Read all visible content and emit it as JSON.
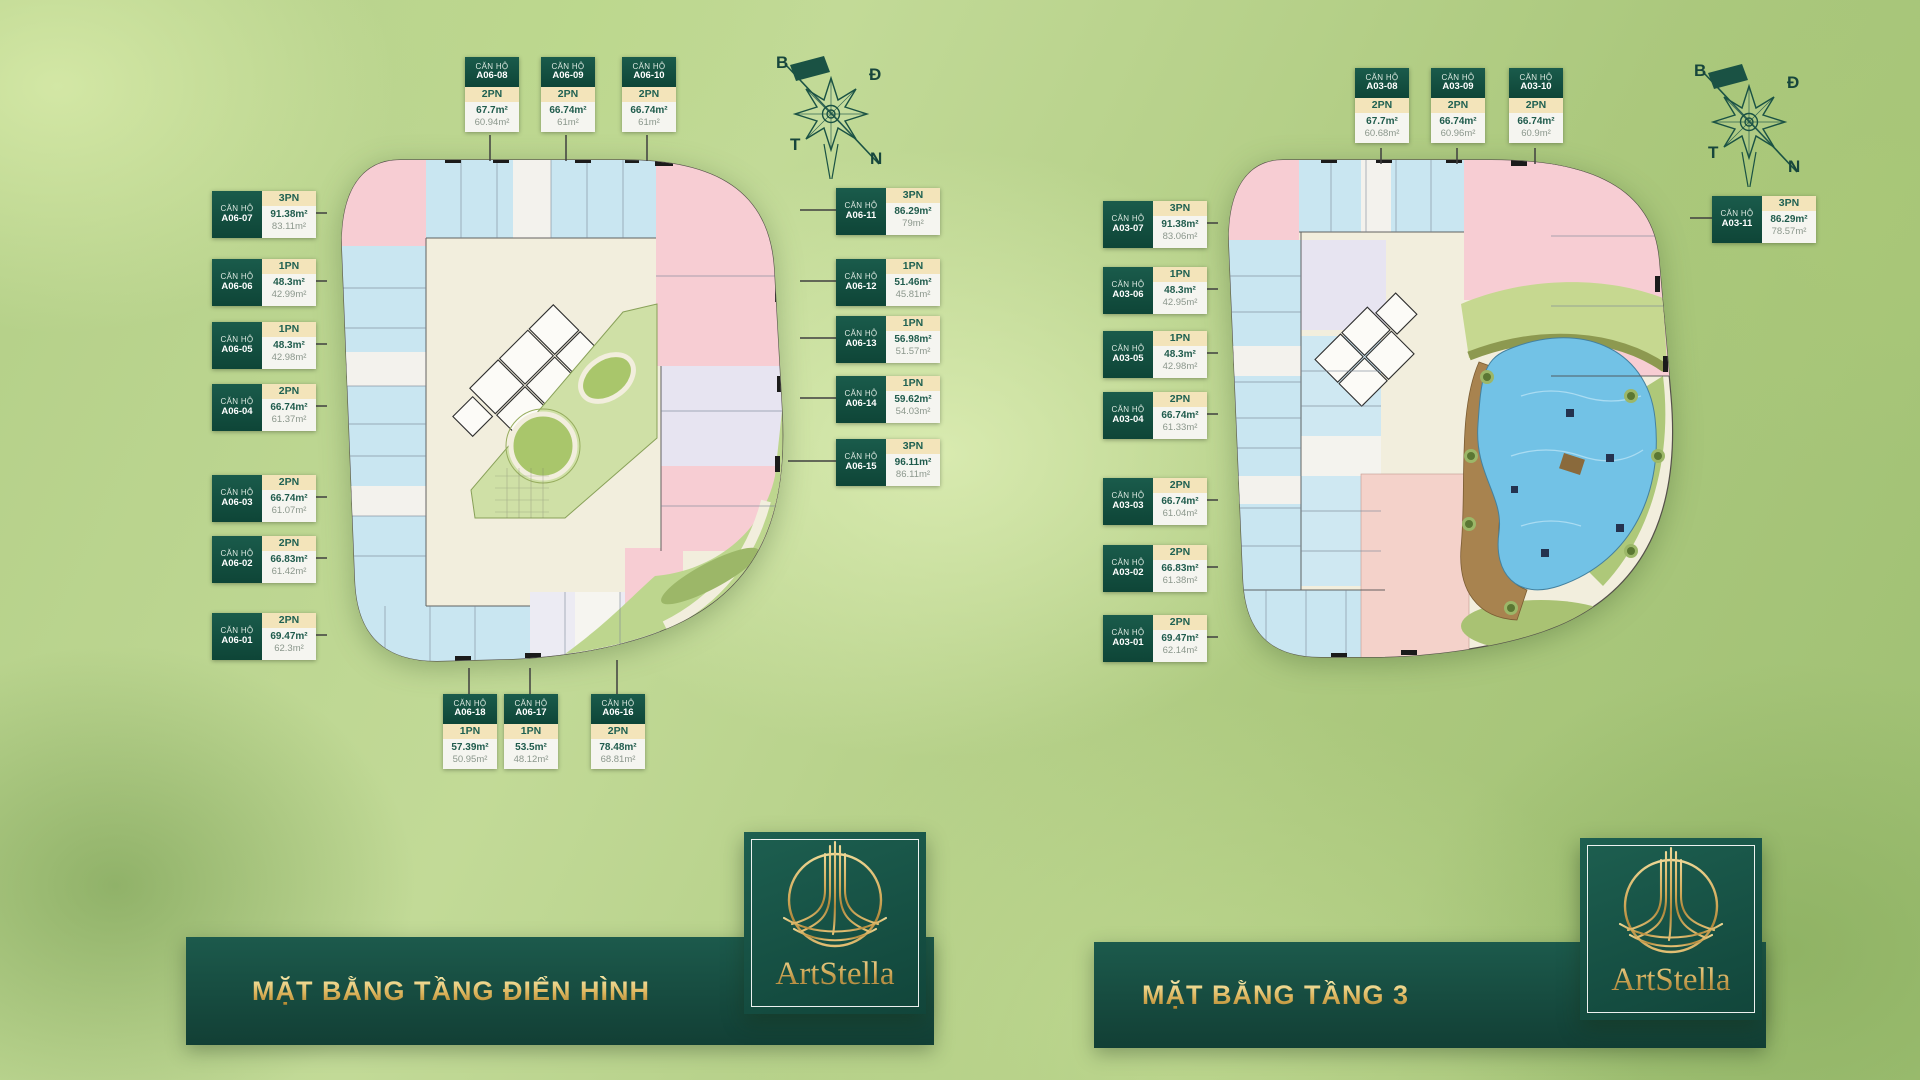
{
  "strings": {
    "unit_prefix": "CĂN HỘ"
  },
  "compass": {
    "north": "B",
    "east": "Đ",
    "west": "T",
    "south": "N"
  },
  "logo": {
    "brand": "ArtStella"
  },
  "colors": {
    "dark_green": "#14503f",
    "gold": "#c9a24b",
    "tag_cream": "#f3e4ba",
    "unit_pink": "#f7cdd3",
    "unit_blue": "#c9e6f1",
    "unit_lavender": "#e7e4f1",
    "courtyard_green": "#cfe0a6",
    "pool_blue": "#72c2e6"
  },
  "plans": [
    {
      "title": "MẶT BẰNG TẦNG ĐIỂN HÌNH",
      "units": [
        {
          "code": "A06-01",
          "pn": "2PN",
          "a1": "69.47m²",
          "a2": "62.3m²"
        },
        {
          "code": "A06-02",
          "pn": "2PN",
          "a1": "66.83m²",
          "a2": "61.42m²"
        },
        {
          "code": "A06-03",
          "pn": "2PN",
          "a1": "66.74m²",
          "a2": "61.07m²"
        },
        {
          "code": "A06-04",
          "pn": "2PN",
          "a1": "66.74m²",
          "a2": "61.37m²"
        },
        {
          "code": "A06-05",
          "pn": "1PN",
          "a1": "48.3m²",
          "a2": "42.98m²"
        },
        {
          "code": "A06-06",
          "pn": "1PN",
          "a1": "48.3m²",
          "a2": "42.99m²"
        },
        {
          "code": "A06-07",
          "pn": "3PN",
          "a1": "91.38m²",
          "a2": "83.11m²"
        },
        {
          "code": "A06-08",
          "pn": "2PN",
          "a1": "67.7m²",
          "a2": "60.94m²"
        },
        {
          "code": "A06-09",
          "pn": "2PN",
          "a1": "66.74m²",
          "a2": "61m²"
        },
        {
          "code": "A06-10",
          "pn": "2PN",
          "a1": "66.74m²",
          "a2": "61m²"
        },
        {
          "code": "A06-11",
          "pn": "3PN",
          "a1": "86.29m²",
          "a2": "79m²"
        },
        {
          "code": "A06-12",
          "pn": "1PN",
          "a1": "51.46m²",
          "a2": "45.81m²"
        },
        {
          "code": "A06-13",
          "pn": "1PN",
          "a1": "56.98m²",
          "a2": "51.57m²"
        },
        {
          "code": "A06-14",
          "pn": "1PN",
          "a1": "59.62m²",
          "a2": "54.03m²"
        },
        {
          "code": "A06-15",
          "pn": "3PN",
          "a1": "96.11m²",
          "a2": "86.11m²"
        },
        {
          "code": "A06-16",
          "pn": "2PN",
          "a1": "78.48m²",
          "a2": "68.81m²"
        },
        {
          "code": "A06-17",
          "pn": "1PN",
          "a1": "53.5m²",
          "a2": "48.12m²"
        },
        {
          "code": "A06-18",
          "pn": "1PN",
          "a1": "57.39m²",
          "a2": "50.95m²"
        }
      ]
    },
    {
      "title": "MẶT BẰNG TẦNG 3",
      "units": [
        {
          "code": "A03-01",
          "pn": "2PN",
          "a1": "69.47m²",
          "a2": "62.14m²"
        },
        {
          "code": "A03-02",
          "pn": "2PN",
          "a1": "66.83m²",
          "a2": "61.38m²"
        },
        {
          "code": "A03-03",
          "pn": "2PN",
          "a1": "66.74m²",
          "a2": "61.04m²"
        },
        {
          "code": "A03-04",
          "pn": "2PN",
          "a1": "66.74m²",
          "a2": "61.33m²"
        },
        {
          "code": "A03-05",
          "pn": "1PN",
          "a1": "48.3m²",
          "a2": "42.98m²"
        },
        {
          "code": "A03-06",
          "pn": "1PN",
          "a1": "48.3m²",
          "a2": "42.95m²"
        },
        {
          "code": "A03-07",
          "pn": "3PN",
          "a1": "91.38m²",
          "a2": "83.06m²"
        },
        {
          "code": "A03-08",
          "pn": "2PN",
          "a1": "67.7m²",
          "a2": "60.68m²"
        },
        {
          "code": "A03-09",
          "pn": "2PN",
          "a1": "66.74m²",
          "a2": "60.96m²"
        },
        {
          "code": "A03-10",
          "pn": "2PN",
          "a1": "66.74m²",
          "a2": "60.9m²"
        },
        {
          "code": "A03-11",
          "pn": "3PN",
          "a1": "86.29m²",
          "a2": "78.57m²"
        }
      ]
    }
  ]
}
